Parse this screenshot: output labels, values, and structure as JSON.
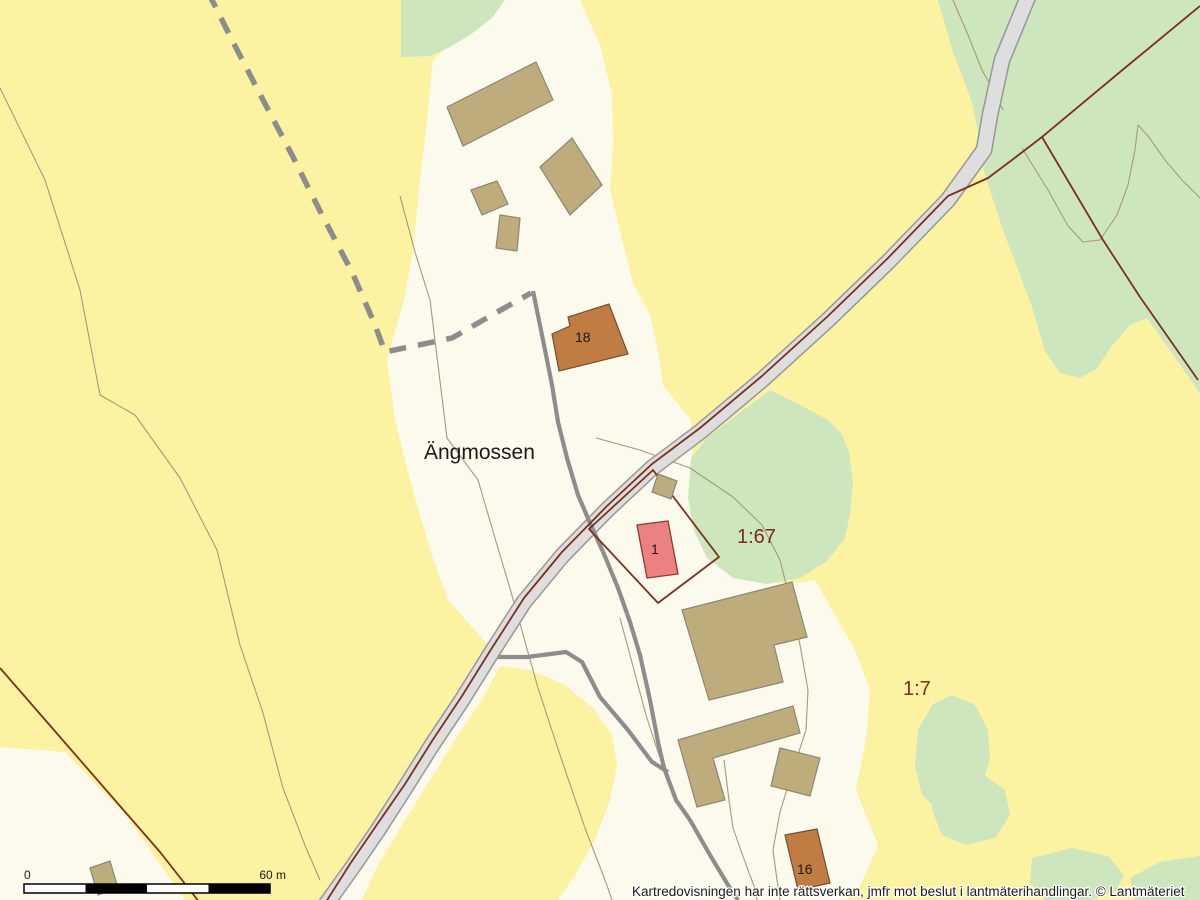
{
  "map": {
    "place_label": "Ängmossen",
    "parcels": {
      "p167": "1:67",
      "p17": "1:7"
    },
    "buildings": {
      "b18": "18",
      "b1": "1",
      "b16": "16"
    }
  },
  "scale_bar": {
    "zero": "0",
    "max": "60 m"
  },
  "footer": {
    "disclaimer": "Kartredovisningen har inte rättsverkan, jmfr mot beslut i lantmäterihandlingar. © Lantmäteriet"
  },
  "colors": {
    "field-yellow": "#FBF3A1",
    "open-cream": "#FCFAEC",
    "forest-green": "#CDE6BE",
    "road-fill": "#DEDEDE",
    "road-casing": "#979797",
    "path-gray": "#8D8D8D",
    "boundary-red": "#7C3120",
    "parcel-text": "#7E2A1C",
    "building-tan": "#BFAC7D",
    "building-tan-stroke": "#8A8776",
    "building-orange": "#C17C43",
    "building-orange-stroke": "#6E5134",
    "building-pink": "#EC8181",
    "building-pink-stroke": "#8E3B2E",
    "contour": "#A49A7E",
    "text-black": "#1A1A1A"
  }
}
